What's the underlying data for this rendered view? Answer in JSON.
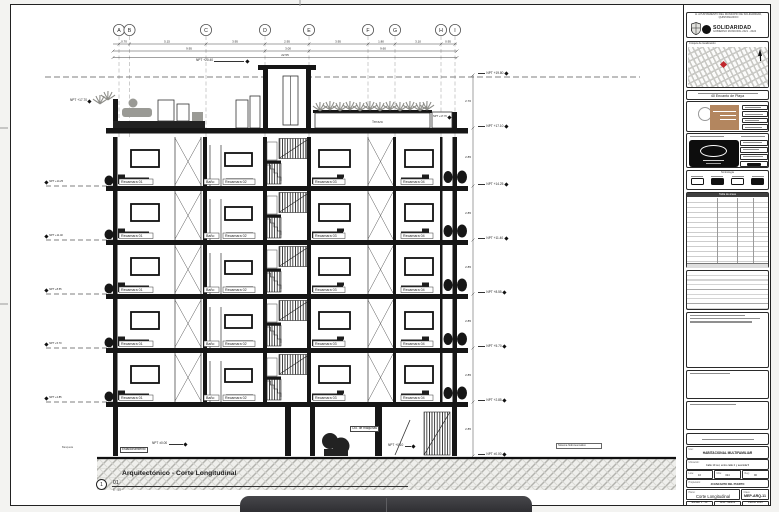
{
  "municipal_header": {
    "top_text": "H. AYUNTAMIENTO DEL MUNICIPIO DE SOLIDARIDAD, QUINTANA ROO",
    "brand": "SOLIDARIDAD",
    "tagline": "GOBIERNO MUNICIPAL 2021 - 2024"
  },
  "map_box": {
    "label": "Croquis de localización",
    "marker_color": "#c0272d"
  },
  "project_box": {
    "name": "40 Encanto de Playa"
  },
  "symbols_box": {
    "title": "Simbología"
  },
  "areas_table": {
    "title": "Tabla de áreas"
  },
  "titleblock": {
    "uso_label": "Uso:",
    "uso": "HABITACIONAL MULTIFAMILIAR",
    "ubicacion_label": "Ubicación:",
    "ubicacion": "Calle 10 sur, entre calle 2 y avenida 5",
    "lote_label": "Lote:",
    "lote": "10",
    "mza_label": "Mza:",
    "mza": "024",
    "reg_label": "Reg.:",
    "reg": "90",
    "prop_label": "Propietario:",
    "propietario": "40 ENCANTO DEL PUERTO",
    "plano_label": "Plano:",
    "plano": "Corte Longitudinal",
    "clave_label": "Clave:",
    "clave": "MEP-ARQ-11",
    "escala_label": "Escala:",
    "escala": "1 : 50",
    "acot_label": "Acot.:",
    "acot": "Metros",
    "fecha_label": "Fecha:",
    "fecha": "2023"
  },
  "drawing_title": {
    "name": "Arquitectónico - Corte Longitudinal",
    "number": "01",
    "scale": "1 : 50",
    "sheet_ref": "1"
  },
  "grid_axes": [
    "A",
    "B",
    "C",
    "D",
    "E",
    "F",
    "G",
    "H",
    "I"
  ],
  "dimensions": {
    "top": [
      "0.70",
      "5.15",
      "3.95",
      "2.95",
      "3.95",
      "1.80",
      "3.10",
      "0.95"
    ],
    "mid": [
      "9.95",
      "3.00",
      "9.60"
    ],
    "total": "22.55",
    "right": [
      "2.70",
      "2.85",
      "2.85",
      "2.85",
      "2.85",
      "2.85",
      "2.85"
    ]
  },
  "levels": {
    "right": [
      "NPT +19.80",
      "NPT +17.10",
      "NPT +14.25",
      "NPT +11.40",
      "NPT +8.55",
      "NPT +5.70",
      "NPT +2.85",
      "NPT ±0.00"
    ],
    "left": [
      "NPT +14.25",
      "NPT +11.40",
      "NPT +8.55",
      "NPT +5.70",
      "NPT +2.85"
    ],
    "roof_bulkhead": "NPT +20.40",
    "roof_terrace": "NPT +17.70",
    "planter": "NPT +17.70"
  },
  "rooms": {
    "r1": "Recamara 01",
    "bath": "Baño",
    "r2": "Recamara 02",
    "r3": "Recamara 03",
    "r4": "Recamara 04",
    "terrace": "Terraza"
  },
  "ground_floor": {
    "label_parking": "Estacionamiento",
    "tag_npt": "NPT ±0.00",
    "label_machine": "Cto. de máquinas",
    "tag_npt2": "NPT +0.10",
    "label_system": "Sistema hidroneumático",
    "label_sidewalk": "Banqueta"
  }
}
